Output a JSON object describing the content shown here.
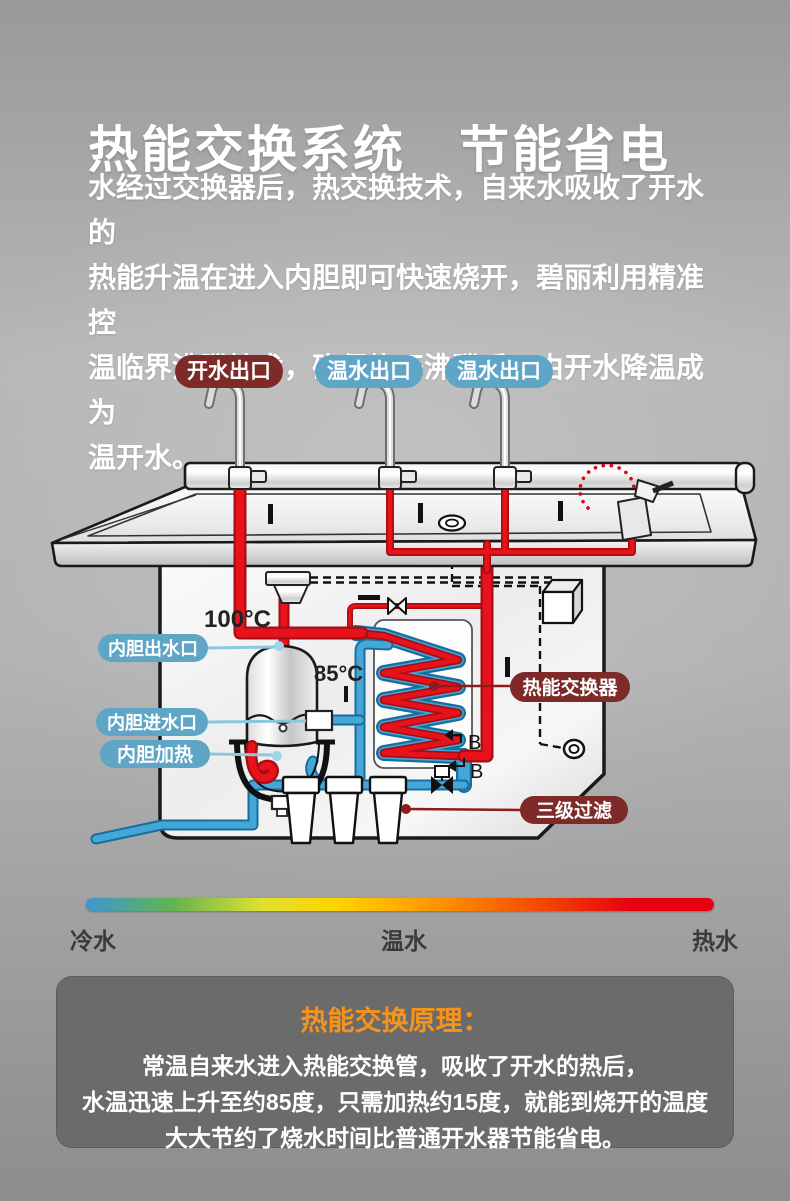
{
  "header": {
    "title": "热能交换系统　节能省电",
    "description": "水经过交换器后，热交换技术，自来水吸收了开水的\n热能升温在进入内胆即可快速烧开，碧丽利用精准控\n温临界沸腾技术，确保烧开沸腾后，由开水降温成为\n温开水。"
  },
  "diagram": {
    "outlet_labels": [
      {
        "text": "开水出口",
        "color": "#7d2a28"
      },
      {
        "text": "温水出口",
        "color": "#5fa6c6"
      },
      {
        "text": "温水出口",
        "color": "#5fa6c6"
      }
    ],
    "part_labels": {
      "tank_outlet": "内胆出水口",
      "tank_inlet": "内胆进水口",
      "tank_heater": "内胆加热",
      "heat_exchanger": "热能交换器",
      "filter": "三级过滤"
    },
    "label_colors": {
      "blue_pill": "#5fa6c6",
      "dark_red_pill": "#7d2a28"
    },
    "temps": {
      "boiling": "100°C",
      "preheated": "85°C"
    },
    "markers": {
      "b1": "B",
      "b2": "B"
    },
    "pipe_colors": {
      "hot": "#e8121c",
      "cold": "#45a6d8"
    }
  },
  "temperature_scale": {
    "labels": {
      "cold": "冷水",
      "warm": "温水",
      "hot": "热水"
    },
    "gradient": [
      "#3f96d2 0%",
      "#63b44e 14%",
      "#dfe032 28%",
      "#ffd400 40%",
      "#ff9000 57%",
      "#f34500 73%",
      "#e60012 87%",
      "#e60012 100%"
    ]
  },
  "principle": {
    "title": "热能交换原理：",
    "title_color": "#f5941d",
    "lines": [
      "常温自来水进入热能交换管，吸收了开水的热后，",
      "水温迅速上升至约85度，只需加热约15度，就能到烧开的温度",
      "大大节约了烧水时间比普通开水器节能省电。"
    ]
  }
}
